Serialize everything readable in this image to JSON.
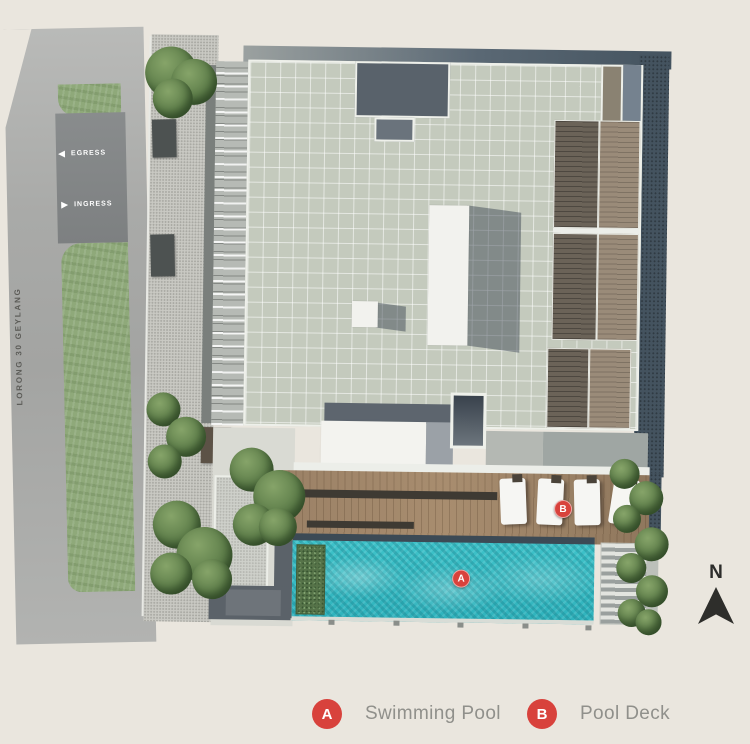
{
  "road": {
    "name": "LORONG 30 GEYLANG",
    "egress": {
      "label": "EGRESS",
      "icon": "arrow-left"
    },
    "ingress": {
      "label": "INGRESS",
      "icon": "arrow-right"
    }
  },
  "compass": {
    "label": "N",
    "icon": "north-triangle"
  },
  "plan_markers": [
    {
      "id": "A"
    },
    {
      "id": "B"
    }
  ],
  "legend": {
    "items": [
      {
        "key": "A",
        "label": "Swimming Pool"
      },
      {
        "key": "B",
        "label": "Pool Deck"
      }
    ]
  },
  "colors": {
    "background": "#eae6de",
    "marker_red": "#d8423c",
    "legend_text": "#90908b",
    "pool_water": "#3ec2c9",
    "deck_wood": "#9b8166",
    "roof_tiles": "#c4cabd",
    "site_boundary": "#44535f",
    "grass": "#8fa97a",
    "road_gray": "#a9aaa8",
    "north_arrow": "#2e2e2b"
  }
}
